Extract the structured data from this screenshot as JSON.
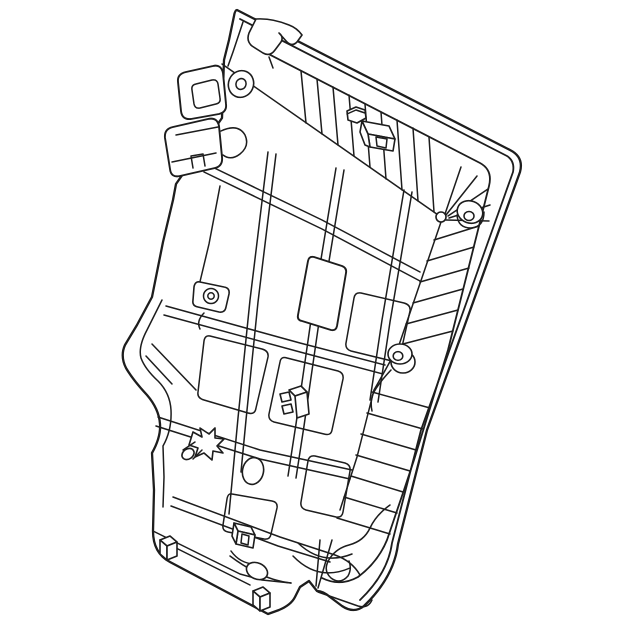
{
  "illustration": {
    "description": "Line-art parts illustration of a vehicle rear seat back panel frame, tilted view, with mounting tabs, screw grommet bosses, retaining clips, ribbed lattice, recessed pockets and base rail feet",
    "line_color": "#1d1d1d",
    "background_color": "#ffffff",
    "features": [
      "panel-outer-shell",
      "hook-bracket",
      "mounting-tab-upper",
      "mounting-tab-lower",
      "grommet-top-left",
      "grommet-top-right",
      "grommet-mid-left",
      "grommet-mid-right",
      "corner-fan-ribs",
      "ladder-ribs-top",
      "ladder-ribs-right",
      "rib-lattice",
      "center-slot",
      "recessed-pockets",
      "star-clip",
      "bracket-clip",
      "hex-clip",
      "box-clip",
      "bottom-clip",
      "oval-hole",
      "base-rail",
      "base-post-left",
      "base-post-right"
    ]
  }
}
